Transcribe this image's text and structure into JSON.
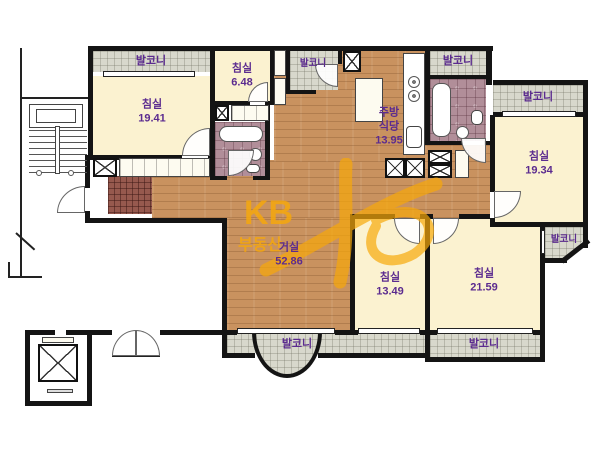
{
  "colors": {
    "wall": "#141414",
    "room": "#FBF2D0",
    "wood": "#C9925F",
    "balcony_tile": "#D8D8CC",
    "bath_tile": "#B18E99",
    "foyer_tile": "#96594E",
    "label": "#5B2B8F",
    "watermark": "#F7A80A"
  },
  "watermark": {
    "brand": "KB",
    "word": "부동산"
  },
  "rooms": {
    "bedroom_tl": {
      "name": "침실",
      "area": "19.41"
    },
    "bedroom_tc": {
      "name": "침실",
      "area": "6.48"
    },
    "kitchen": {
      "name": "주방",
      "name2": "식당",
      "area": "13.95"
    },
    "bedroom_r": {
      "name": "침실",
      "area": "19.34"
    },
    "living": {
      "name": "거실",
      "area": "52.86"
    },
    "bedroom_bc": {
      "name": "침실",
      "area": "13.49"
    },
    "bedroom_br": {
      "name": "침실",
      "area": "21.59"
    }
  },
  "balconies": {
    "top_left": "발코니",
    "top_center": "발코니",
    "top_right": "발코니",
    "right": "발코니",
    "right_small": "발코니",
    "bottom_left": "발코니",
    "bottom_right": "발코니"
  }
}
